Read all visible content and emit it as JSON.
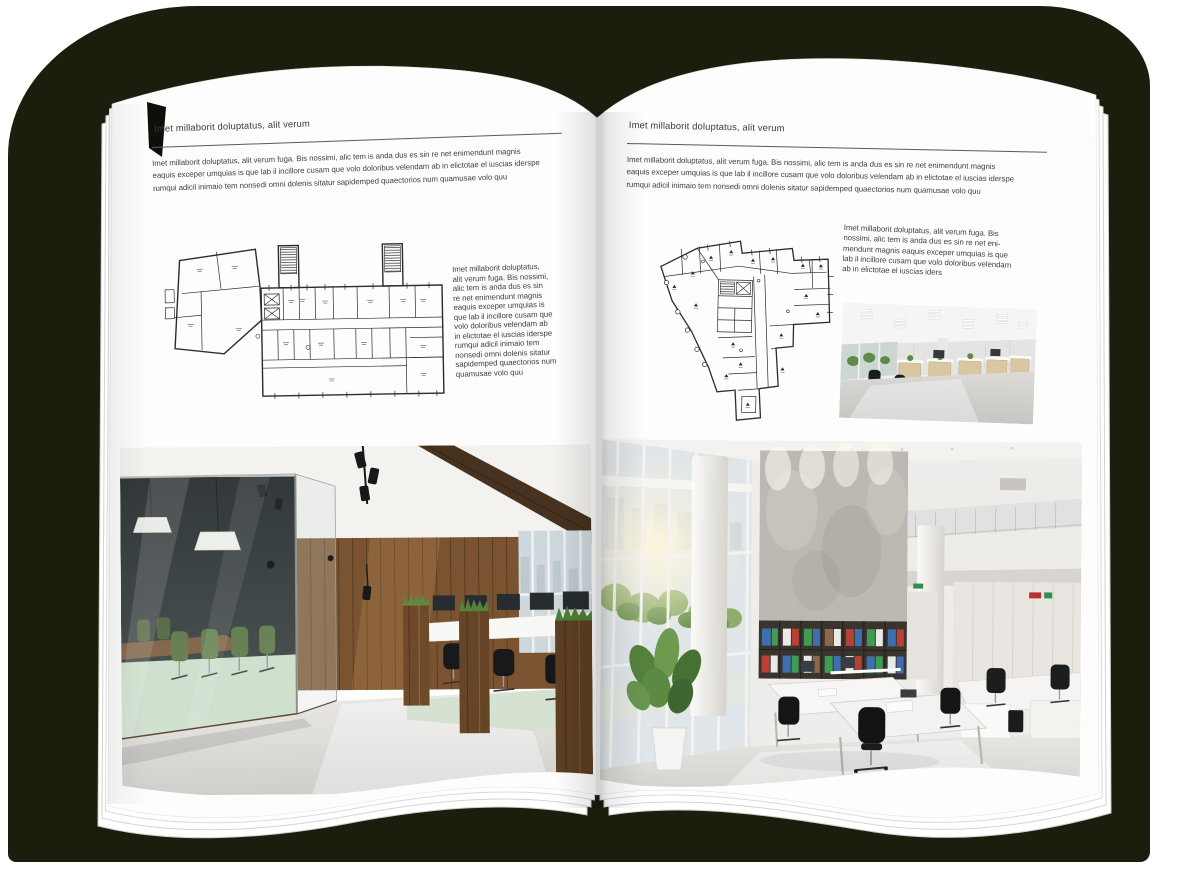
{
  "canvas": {
    "background_color": "#ffffff",
    "backdrop_color": "#1b1d0d",
    "page_color": "#fdfdfd",
    "text_color": "#3d3d3d"
  },
  "left_page": {
    "header": "Imet millaborit doluptatus, alit verum",
    "intro": "Imet millaborit doluptatus, alit verum fuga. Bis nossimi, alic tem is anda dus es sin re net enimendunt magnis\neaquis exceper umquias is que lab il incillore cusam que volo doloribus velendam ab in elictotae el iuscias iderspe\nrumqui adicil inimaio tem nonsedi omni dolenis sitatur sapidemped quaectorios num quamusae volo quu",
    "side_text": "Imet millaborit doluptatus,\nalit verum fuga. Bis nossimi,\nalic tem is anda dus es sin\nre net enimendunt magnis\neaquis exceper umquias is\nque lab il incillore cusam que\nvolo doloribus velendam ab\nin elictotae el iuscias iderspe\nrumqui adicil inimaio tem\nnonsedi omni dolenis sitatur\nsapidemped quaectorios num\nquamusae volo quu",
    "floor_plan_name": "building-floor-plan-drawing",
    "photo_name": "loft-office-interior-photo"
  },
  "right_page": {
    "header": "Imet millaborit doluptatus, alit verum",
    "intro": "Imet millaborit doluptatus, alit verum fuga. Bis nossimi, alic tem is anda dus es sin re net enimendunt magnis\neaquis exceper umquias is que lab il incillore cusam que volo doloribus velendam ab in elictotae el iuscias iderspe\nrumqui adicil inimaio tem nonsedi omni dolenis sitatur sapidemped quaectorios num quamusae volo quu",
    "side_text": "Imet millaborit doluptatus, alit verum fuga. Bis\nnossimi, alic tem is anda dus es sin re net eni-\nmendunt magnis eaquis exceper umquias is que\nlab il incillore cusam que volo doloribus velendam\nab in elictotae el iuscias iders",
    "floor_plan_name": "irregular-building-floor-plan-drawing",
    "small_photo_name": "open-space-office-photo",
    "photo_name": "bright-atrium-office-photo"
  }
}
